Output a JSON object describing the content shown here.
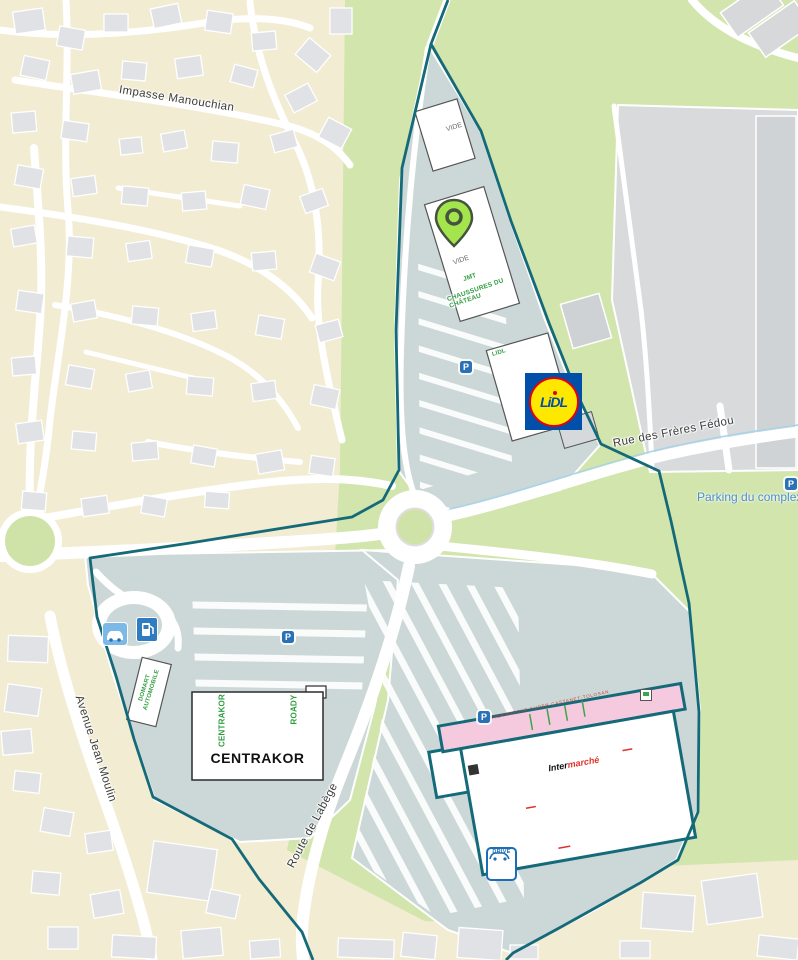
{
  "streets": {
    "impasse_manouchian": "Impasse Manouchian",
    "rue_des_freres_fedou": "Rue des Frères Fédou",
    "avenue_jean_moulin": "Avenue Jean Moulin",
    "route_de_labege": "Route de Labège"
  },
  "poi": {
    "parking_complexe": "Parking du complexe",
    "parking_letter": "P",
    "drive": "DRIVE"
  },
  "units": {
    "vide": "VIDE",
    "jmt": "JMT",
    "chaussures_du_chateau": "CHAUSSURES DU CHÂTEAU",
    "lidl_small": "LIDL",
    "lidl_logo": "LiDL",
    "centrakor": "CENTRAKOR",
    "roady": "ROADY",
    "domart_automobile": "DOMART AUTOMOBILE",
    "intermarche_band": "INTERMARCHE SUPER CASTANET-TOLOSAN",
    "intermarche_inter": "Inter",
    "intermarche_marche": "marché"
  },
  "icons": {
    "pin": "location-pin",
    "parking": "parking-icon",
    "car_wash": "car-wash-icon",
    "fuel": "fuel-station-icon",
    "drive": "drive-pickup-icon",
    "cart": "cart-icon"
  },
  "colors": {
    "boundary_teal": "#156a7a",
    "vegetation_green": "#d2e5ad",
    "residential_beige": "#f2ecd2",
    "parking_grayblue": "#ccd8d7",
    "complex_gray": "#d8dadc",
    "store_green_text": "#2f9e3f",
    "pin_green": "#a4e44c",
    "lidl_blue": "#0050aa",
    "lidl_yellow": "#ffe800",
    "lidl_red": "#e3000f",
    "intermarche_pink": "#f5cade",
    "poi_blue": "#4b8fc8",
    "parking_icon_blue": "#2a72b5"
  }
}
